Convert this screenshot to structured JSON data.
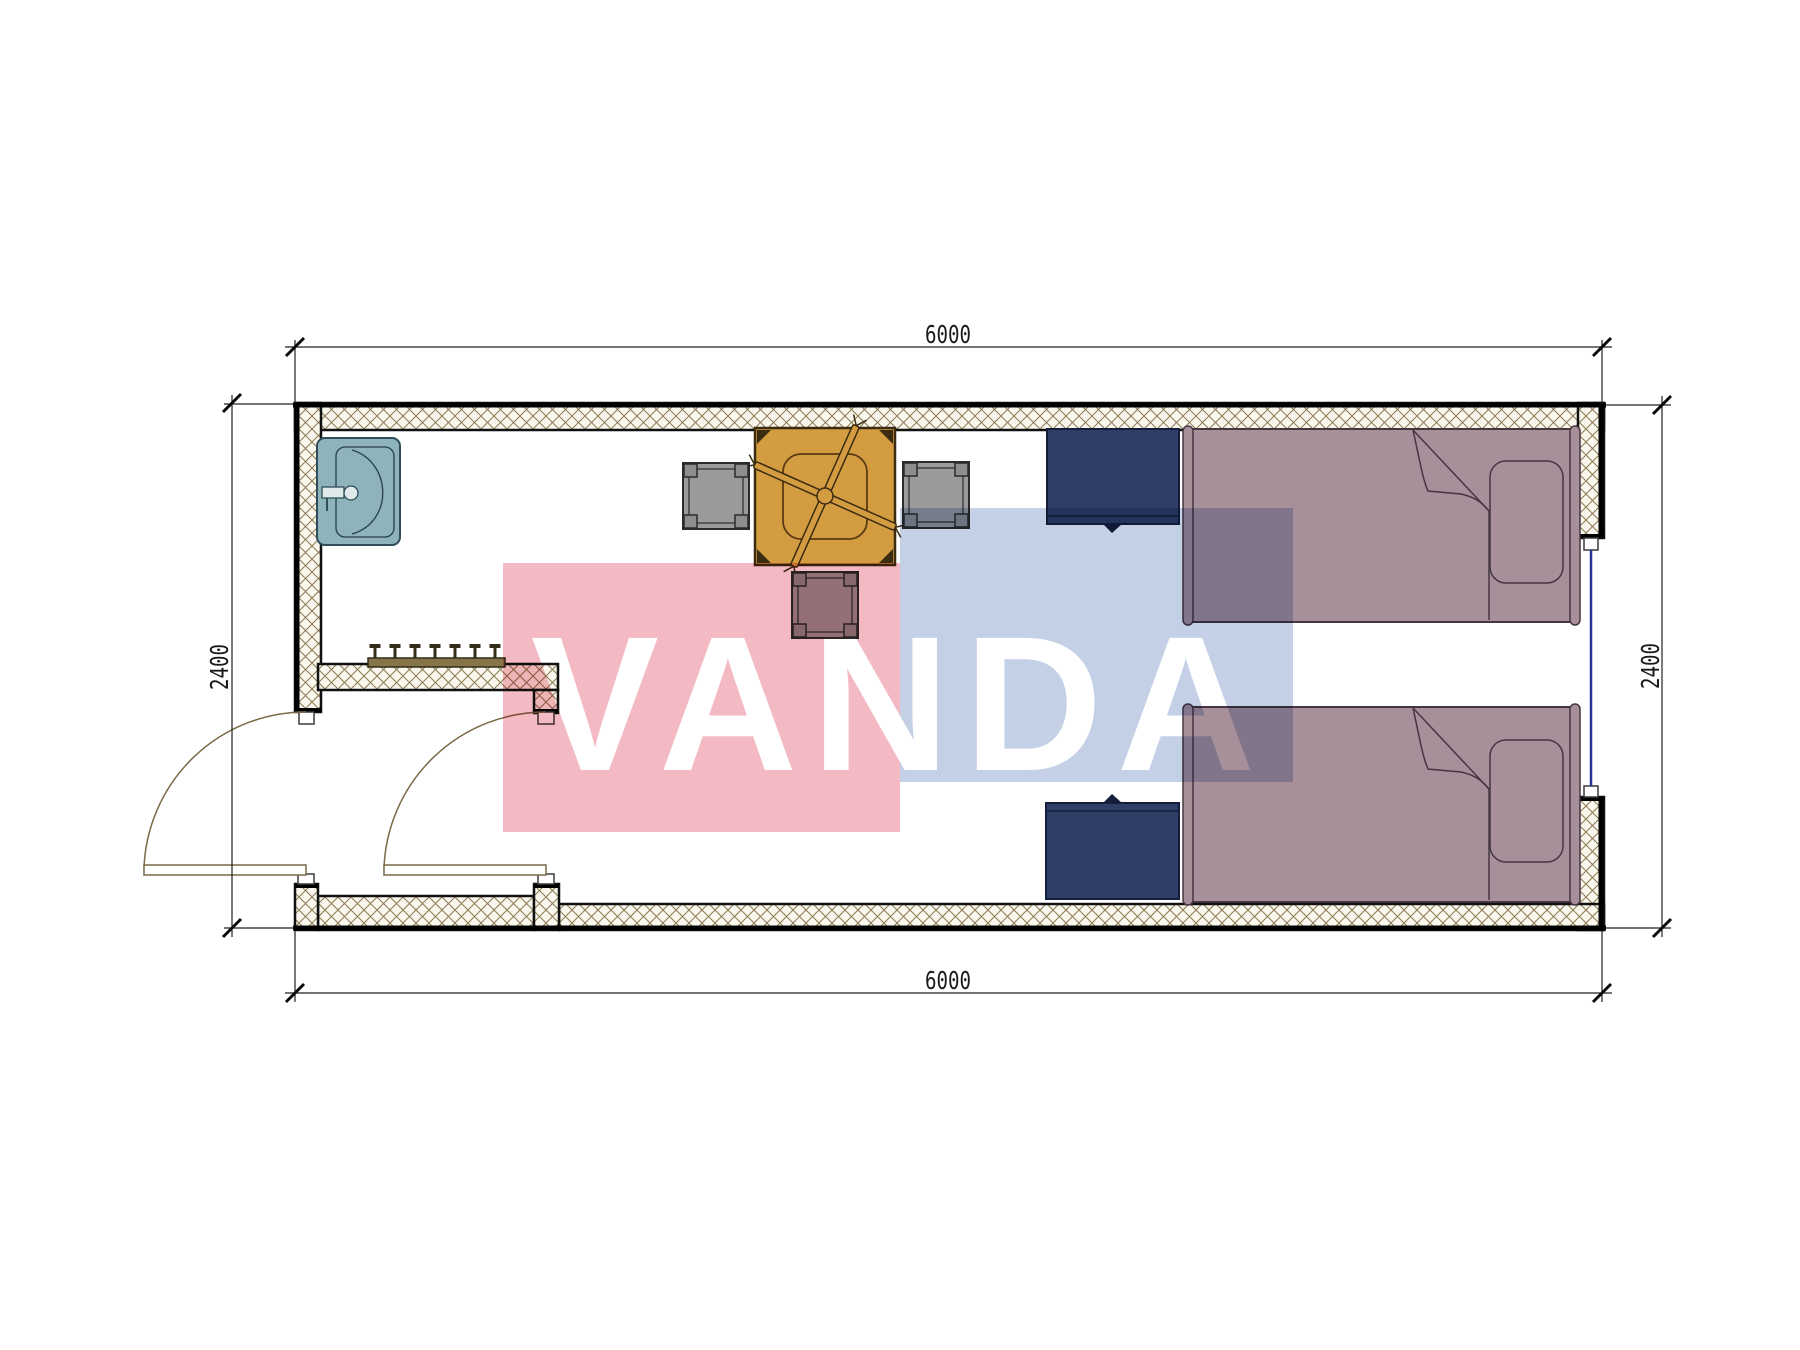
{
  "watermark": {
    "text": "VANDA",
    "pink_color": "#f3bac3",
    "blue_color": "#c3d0e6"
  },
  "dimensions": {
    "top": "6000",
    "bottom": "6000",
    "left": "2400",
    "right": "2400"
  },
  "palette": {
    "wall_outline": "#0d0d0d",
    "hatch_line": "#8a7a52",
    "hatch_bg": "#faf7ee",
    "sink": "#8fb3ba",
    "sink_fixture": "#dfe9ea",
    "table": "#d49c40",
    "table_detail": "#3a2c10",
    "chair": "#9a9a9a",
    "nightstand": "#2f3e66",
    "bed": "#a8909a",
    "bed_line": "#463642",
    "window": "#283593",
    "door": "#7a6a45",
    "dim_line": "#222222"
  },
  "furniture": [
    {
      "name": "sink"
    },
    {
      "name": "coat-rack"
    },
    {
      "name": "dining-table"
    },
    {
      "name": "stool-left"
    },
    {
      "name": "stool-right"
    },
    {
      "name": "stool-bottom"
    },
    {
      "name": "nightstand-top"
    },
    {
      "name": "nightstand-bottom"
    },
    {
      "name": "single-bed-top"
    },
    {
      "name": "single-bed-bottom"
    },
    {
      "name": "window-right"
    },
    {
      "name": "entry-door"
    },
    {
      "name": "inner-door"
    }
  ]
}
